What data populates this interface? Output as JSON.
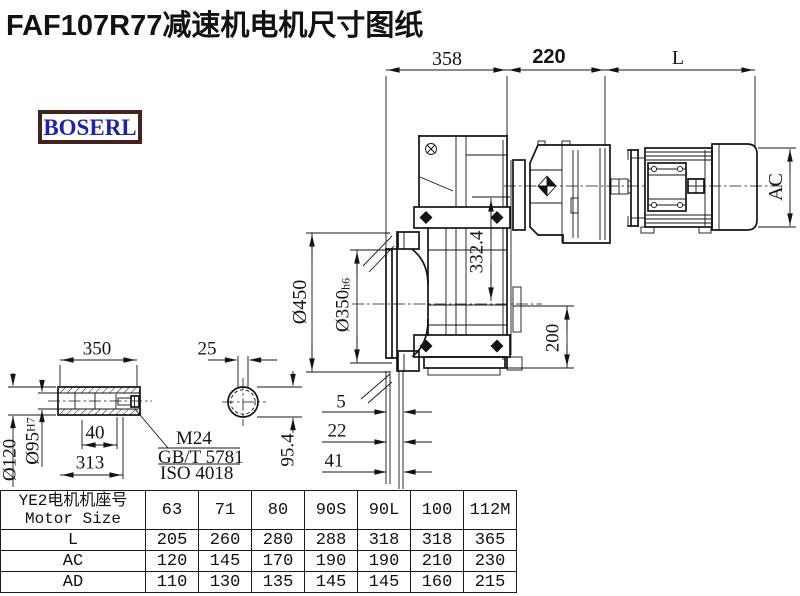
{
  "title": "FAF107R77减速机电机尺寸图纸",
  "logo": {
    "text": "BOSERL"
  },
  "drawing": {
    "dims": {
      "len_gearbox": "358",
      "len_adapter": "220",
      "len_motor": "L",
      "motor_diameter": "AC",
      "axis_height": "332.4",
      "flange_od": "Ø450",
      "flange_spigot": "Ø350",
      "flange_spigot_tol": "h6",
      "height_200": "200",
      "offset_5": "5",
      "offset_22": "22",
      "offset_41": "41",
      "shaft_length": "350",
      "key_width": "25",
      "shaft_od": "Ø120",
      "bore": "Ø95",
      "bore_tol": "H7",
      "dim_40": "40",
      "dim_313": "313",
      "bore_key_height": "95.4",
      "bolt_thread": "M24",
      "bolt_std_gb": "GB/T 5781",
      "bolt_std_iso": "ISO 4018"
    }
  },
  "table": {
    "header_cn": "YE2电机机座号",
    "header_en": "Motor Size",
    "sizes": [
      "63",
      "71",
      "80",
      "90S",
      "90L",
      "100",
      "112M"
    ],
    "rows": [
      {
        "label": "L",
        "values": [
          "205",
          "260",
          "280",
          "288",
          "318",
          "318",
          "365"
        ]
      },
      {
        "label": "AC",
        "values": [
          "120",
          "145",
          "170",
          "190",
          "190",
          "210",
          "230"
        ]
      },
      {
        "label": "AD",
        "values": [
          "110",
          "130",
          "135",
          "145",
          "145",
          "160",
          "215"
        ]
      }
    ]
  }
}
